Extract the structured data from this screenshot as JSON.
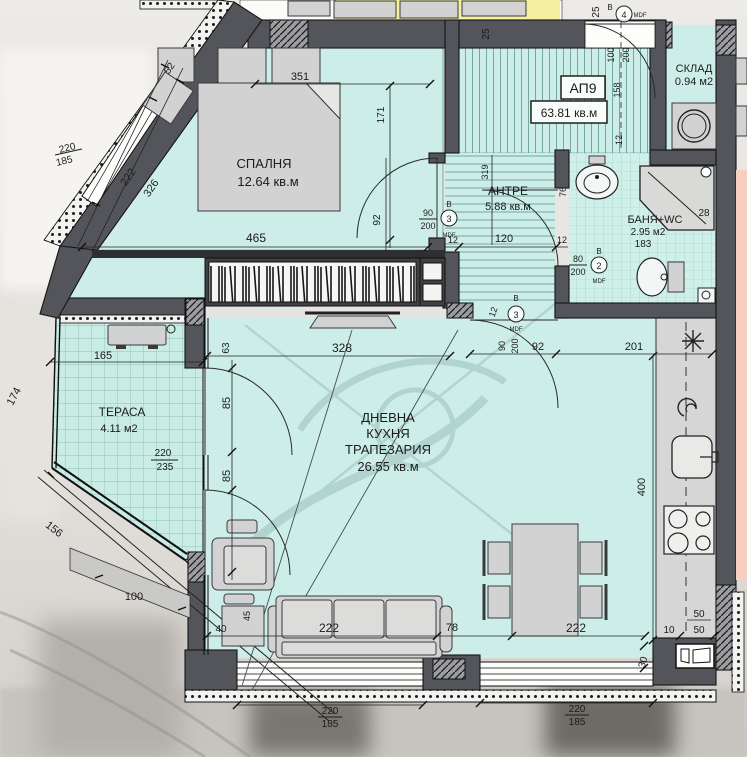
{
  "unit": {
    "id": "АП9",
    "area": "63.81 кв.м"
  },
  "rooms": {
    "bedroom": {
      "name": "СПАЛНЯ",
      "area": "12.64 кв.м"
    },
    "hall": {
      "name": "АНТРЕ",
      "area": "5.88 кв.м"
    },
    "living": {
      "line1": "ДНЕВНА",
      "line2": "КУХНЯ",
      "line3": "ТРАПЕЗАРИЯ",
      "area": "26.55 кв.м"
    },
    "terrace": {
      "name": "ТЕРАСА",
      "area": "4.11 м2"
    },
    "bath": {
      "name": "БАНЯ+WC",
      "area": "2.95 м2"
    },
    "storage": {
      "name": "СКЛАД",
      "area": "0.94 м2"
    }
  },
  "doors": {
    "type_letter": "В",
    "material": "MDF",
    "n2": "2",
    "n3": "3",
    "n4": "4",
    "w80": "80",
    "w90": "90",
    "w100": "100",
    "h200": "200"
  },
  "dims": {
    "d25": "25",
    "d52": "52",
    "d351": "351",
    "d171": "171",
    "d222": "222",
    "d326": "326",
    "d220": "220",
    "d185": "185",
    "d465": "465",
    "d92": "92",
    "d158": "158",
    "d12": "12",
    "d319": "319",
    "d120": "120",
    "d100": "100",
    "d183": "183",
    "d76": "76",
    "d28": "28",
    "d63": "63",
    "d328": "328",
    "d201": "201",
    "d165": "165",
    "d174": "174",
    "d85": "85",
    "d235": "235",
    "d156": "156",
    "d400": "400",
    "d40": "40",
    "d45": "45",
    "d78": "78",
    "d50": "50",
    "d10": "10",
    "d30": "30"
  },
  "colors": {
    "floor": "#cdeee8",
    "wall": "#55565a",
    "highlight_yellow": "#f5efa0",
    "highlight_pink": "#f6cfc2"
  }
}
